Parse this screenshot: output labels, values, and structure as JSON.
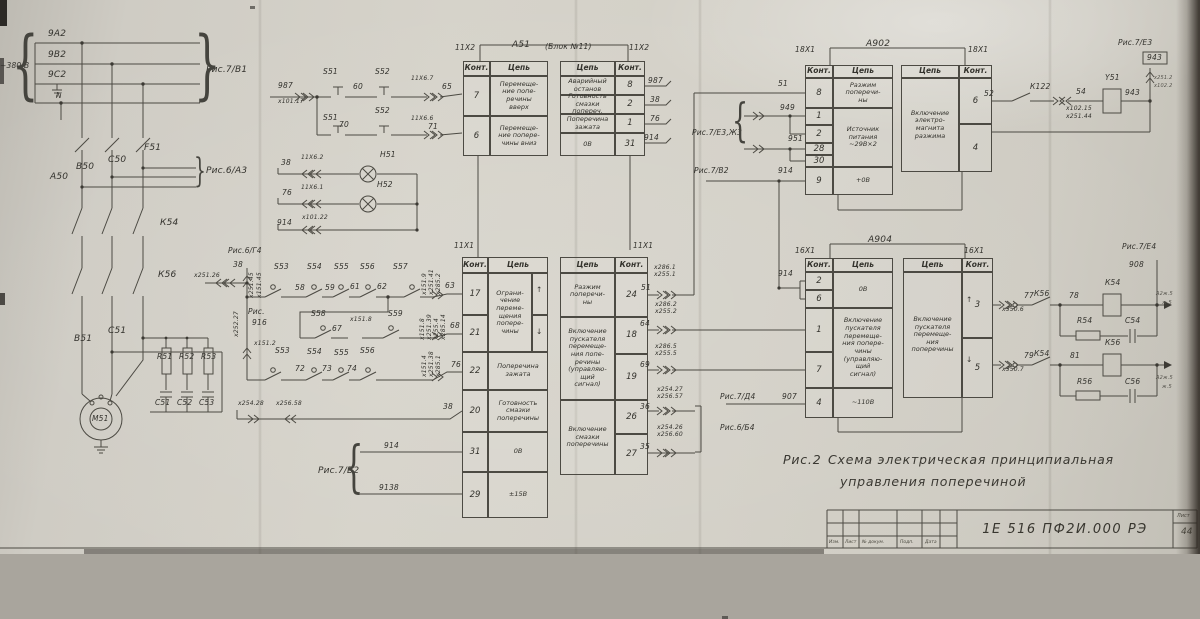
{
  "doc": {
    "caption_fig": "Рис.2",
    "caption_line1": "Схема электрическая принципиальная",
    "caption_line2": "управления поперечиной"
  },
  "title": {
    "code": "1Е 516 ПФ2И.000 РЭ",
    "sheet": "Лист",
    "number": "44",
    "cols": [
      "Изм.",
      "Лист",
      "№ докум.",
      "Подп.",
      "Дата"
    ]
  },
  "hdr": {
    "pin": "Конт.",
    "cir": "Цепь"
  },
  "blocks": {
    "a51": {
      "l": {
        "r1_pin": "7",
        "r1_cir": "Перемеще-\nние попе-\nречины\nвверх",
        "r2_pin": "6",
        "r2_cir": "Перемеще-\nние попере-\nчины вниз"
      },
      "r": {
        "r1_cir": "Аварийный\nостанов",
        "r1_pin": "8",
        "r2_cir": "Готовность\nсмазки попереч.",
        "r2_pin": "2",
        "r3_cir": "Поперечина\nзажата",
        "r3_pin": "1",
        "r4_cir": "0В",
        "r4_pin": "31"
      }
    },
    "x1": {
      "l": {
        "p17": "17",
        "p21": "21",
        "cir_limit": "Ограни-\nчение\nпереме-\nщения\nпопере-\nчины",
        "p22": "22",
        "cir22": "Поперечина\nзажата",
        "p20": "20",
        "cir20": "Готовность\nсмазки\nпоперечины",
        "p31": "31",
        "cir31": "0В",
        "p29": "29",
        "cir29": "±15В"
      },
      "r": {
        "cir24": "Разжим\nпоперечи-\nны",
        "p24": "24",
        "cir18": "Включение\nпускателя\nперемеще-\nния попе-\nречины\n(управляю-\nщий\nсигнал)",
        "p18": "18",
        "p19": "19",
        "cir26": "Включение\nсмазки\nпоперечины",
        "p26": "26",
        "p27": "27"
      }
    },
    "a902": {
      "l": {
        "p8": "8",
        "cir8": "Разжим\nпоперечи-\nны",
        "p1": "1",
        "p2": "2",
        "p28": "28",
        "p30": "30",
        "cir_src": "Источник\nпитания\n~29В×2",
        "p9": "9",
        "cir9": "+0В"
      },
      "r": {
        "cir": "Включение\nэлектро-\nмагнита\nразжима",
        "p6": "6",
        "p4": "4"
      }
    },
    "a904": {
      "l": {
        "p2": "2",
        "p6": "6",
        "cir0": "0В",
        "p1": "1",
        "p7": "7",
        "cir17": "Включение\nпускателя\nперемеще-\nния попере-\nчины\n(управляю-\nщий\nсигнал)",
        "p4": "4",
        "cir4": "~110В"
      },
      "r": {
        "cir": "Включение\nпускателя\nперемеще-\nния\nпоперечины",
        "p3": "3",
        "p5": "5"
      }
    }
  },
  "labels": {
    "a2": "9А2",
    "b2": "9В2",
    "c2": "9С2",
    "n": "N",
    "v380": "~380 В",
    "ris7v1": "Рис.7/В1",
    "f51": "F51",
    "c50": "С50",
    "b50": "В50",
    "a50": "А50",
    "ris6a3": "Рис.6/А3",
    "k54": "К54",
    "k56": "К56",
    "b51": "В51",
    "c51": "С51",
    "m51": "М51",
    "r51": "R51",
    "r52": "R52",
    "r53": "R53",
    "c51c": "С51",
    "c52c": "С52",
    "c53c": "С53",
    "ris6g4": "Рис.6/Г4",
    "w38a": "38",
    "x25145": "х251.45",
    "x15145": "х151.45",
    "x25126": "х251.26",
    "x25227": "х252.27",
    "risl": "Рис.",
    "w916": "916",
    "x1512": "х151.2",
    "s53a": "S53",
    "s54a": "S54",
    "s55a": "S55",
    "s56a": "S56",
    "s57a": "S57",
    "w58": "58",
    "w59": "59",
    "w61": "61",
    "w62": "62",
    "w63": "63",
    "x1519": "х151.9",
    "x25141": "х251.41",
    "x2852": "х285.2",
    "s58": "S58",
    "w67": "67",
    "x1518a": "х151.8",
    "s59": "S59",
    "w68": "68",
    "x1518b": "х151.8",
    "x25139": "х251.39",
    "x2554": "х255.4",
    "x28514": "х285.14",
    "s53b": "S53",
    "s54b": "S54",
    "s55b": "S55",
    "s56b": "S56",
    "w72": "72",
    "w73": "73",
    "w74": "74",
    "w76c": "76",
    "x1514": "х151.4",
    "x25138": "х251.38",
    "x2851": "х285.1",
    "x25428a": "х254.28",
    "x25658": "х256.58",
    "w38b": "38",
    "ris7v2a": "Рис.7/В2",
    "w914a": "914",
    "w9138": "9138",
    "w987a": "987",
    "x10117": "х101.17",
    "s51a": "S51",
    "w60": "60",
    "s52a": "S52",
    "x11x67": "11X6.7",
    "w65": "65",
    "s51b": "S51",
    "w70": "70",
    "s52b": "S52",
    "x11x66": "11X6.6",
    "w71": "71",
    "w38c": "38",
    "x11x62": "11X6.2",
    "h51": "Н51",
    "w76a": "76",
    "x11x61": "11X6.1",
    "h52": "Н52",
    "w914b": "914",
    "x10122": "х101.22",
    "w987b": "987",
    "w38d": "38",
    "w76b": "76",
    "w914c": "914",
    "x11x2a": "11X2",
    "x11x2b": "11X2",
    "x11x1a": "11X1",
    "x11x1b": "11X1",
    "t_a51": "А51",
    "t_a51s": "(Блок №11)",
    "t_a902": "А902",
    "t_a904": "А904",
    "x2861": "х286.1",
    "x2551": "х255.1",
    "w51": "51",
    "x2862": "х286.2",
    "x2552": "х255.2",
    "w64": "64",
    "x2865": "х286.5",
    "x2555": "х255.5",
    "w69": "69",
    "x25427": "х254.27",
    "x25657": "х256.57",
    "w36": "36",
    "x25426": "х254.26",
    "x25660": "х256.60",
    "w35": "35",
    "ris7d4": "Рис.7/Д4",
    "w907": "907",
    "ris6b4": "Рис.6/Б4",
    "w914d": "914",
    "c18x1a": "18X1",
    "c18x1b": "18X1",
    "w51b": "51",
    "ris7e3zh3": "Рис.7/Е3,Ж3",
    "w949": "949",
    "w951": "951",
    "ris7v2b": "Рис.7/В2",
    "w914e": "914",
    "w52": "52",
    "k122": "К122",
    "w54": "54",
    "x10215": "х102.15",
    "x25144": "х251.44",
    "y51": "Y51",
    "w943a": "943",
    "ris7e3": "Рис.7/Е3",
    "w943b": "943",
    "x2512": "х251.2",
    "x1022": "х102.2",
    "c16x1a": "16X1",
    "c16x1b": "16X1",
    "w77": "77",
    "x5506": "х550.6",
    "k56b": "К56",
    "w78": "78",
    "k54c": "К54",
    "r54": "R54",
    "c54": "С54",
    "ris7e4": "Рис.7/Е4",
    "w908": "908",
    "w79": "79",
    "x5507": "х550.7",
    "k54b": "К54",
    "w81": "81",
    "k56c": "К56",
    "r56": "R56",
    "c56": "С56",
    "edge1a": "А2ж.5",
    "edge1b": "ж.5",
    "edge2a": "А2ж.5",
    "edge2b": "ж.5",
    "x1up": "↑",
    "x1dn": "↓",
    "a904up": "↑",
    "a904dn": "↓",
    "br380": "{",
    "brv1": "}",
    "bra3": "}",
    "brv2": "{",
    "bre3": "{"
  }
}
